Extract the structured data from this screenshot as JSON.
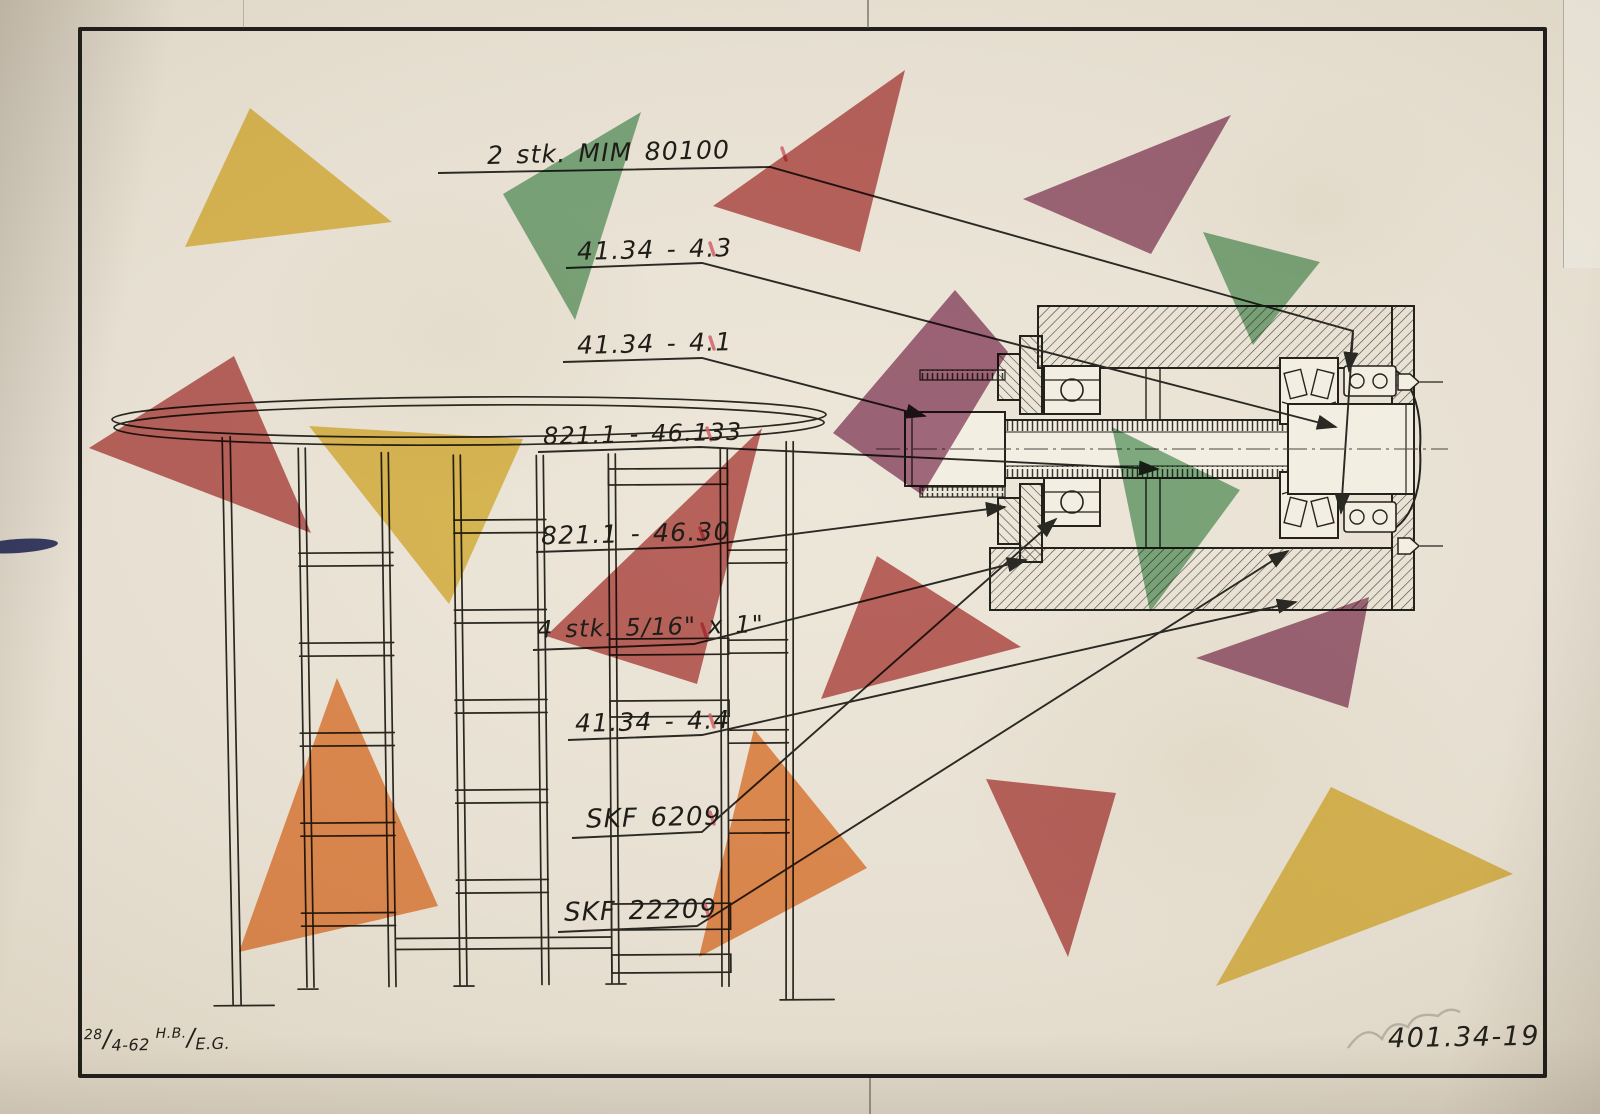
{
  "document_type": "vintage engineering drawing with colored paper triangles",
  "colors": {
    "paper_outer": "#b6ad9e",
    "paper_inner": "#e7e0d2",
    "border": "#211f1b",
    "ink": "#2b2923",
    "yellow": "#e7c350",
    "green": "#77ad82",
    "red": "#bf5c5b",
    "purple": "#9e5e7d",
    "orange": "#ee8d4b",
    "tick_red": "#d4606b",
    "ink_blot_blue": "#272c55",
    "pencil": "#8d867a"
  },
  "callouts": [
    {
      "id": "mim-80100",
      "text": "2 stk. MIM 80100",
      "x": 487,
      "y": 138,
      "size": 25,
      "leaders": [
        [
          [
            438,
            173
          ],
          [
            770,
            167
          ],
          [
            1353,
            331
          ],
          [
            1349,
            371
          ]
        ],
        [
          [
            1353,
            333
          ],
          [
            1341,
            513
          ]
        ]
      ],
      "tick": [
        782,
        148
      ]
    },
    {
      "id": "41-34-4-3",
      "text": "41.34 - 4.3",
      "x": 577,
      "y": 235,
      "size": 25,
      "leaders": [
        [
          [
            566,
            268
          ],
          [
            702,
            263
          ],
          [
            1336,
            427
          ]
        ]
      ],
      "tick": [
        710,
        243
      ]
    },
    {
      "id": "41-34-4-1",
      "text": "41.34 - 4.1",
      "x": 577,
      "y": 329,
      "size": 25,
      "leaders": [
        [
          [
            563,
            362
          ],
          [
            702,
            358
          ],
          [
            925,
            416
          ]
        ]
      ],
      "tick": [
        710,
        337
      ]
    },
    {
      "id": "821-1-46-133",
      "text": "821.1 - 46.133",
      "x": 543,
      "y": 420,
      "size": 24,
      "leaders": [
        [
          [
            538,
            452
          ],
          [
            700,
            447
          ],
          [
            1158,
            469
          ]
        ]
      ],
      "tick": [
        707,
        428
      ]
    },
    {
      "id": "821-1-46-30",
      "text": "821.1 - 46.30",
      "x": 541,
      "y": 519,
      "size": 25,
      "leaders": [
        [
          [
            536,
            552
          ],
          [
            692,
            547
          ],
          [
            1005,
            507
          ]
        ]
      ],
      "tick": [
        700,
        528
      ]
    },
    {
      "id": "4-stk-5-16-x-1",
      "text": "4 stk. 5/16\" x 1\"",
      "x": 537,
      "y": 613,
      "size": 24,
      "leaders": [
        [
          [
            533,
            650
          ],
          [
            694,
            644
          ],
          [
            1026,
            560
          ]
        ]
      ],
      "tick": [
        702,
        624
      ]
    },
    {
      "id": "41-34-4-4",
      "text": "41.34 - 4.4",
      "x": 575,
      "y": 707,
      "size": 25,
      "leaders": [
        [
          [
            568,
            740
          ],
          [
            702,
            735
          ],
          [
            1296,
            602
          ]
        ]
      ],
      "tick": [
        710,
        715
      ]
    },
    {
      "id": "skf-6209",
      "text": "SKF 6209",
      "x": 586,
      "y": 803,
      "size": 26,
      "leaders": [
        [
          [
            572,
            838
          ],
          [
            702,
            832
          ],
          [
            1056,
            519
          ]
        ]
      ],
      "tick": [
        710,
        812
      ]
    },
    {
      "id": "skf-22209",
      "text": "SKF 22209",
      "x": 564,
      "y": 896,
      "size": 26,
      "leaders": [
        [
          [
            558,
            932
          ],
          [
            697,
            926
          ],
          [
            1288,
            551
          ]
        ]
      ],
      "tick": [
        705,
        905
      ]
    }
  ],
  "shapes": [
    {
      "color": "yellow",
      "points": "250,108 392,222 185,247"
    },
    {
      "color": "green",
      "points": "641,112 503,194 575,320"
    },
    {
      "color": "red",
      "points": "905,70 713,206 860,252"
    },
    {
      "color": "purple",
      "points": "1231,115 1023,199 1151,254"
    },
    {
      "color": "green",
      "points": "1203,232 1320,262 1253,345"
    },
    {
      "color": "purple",
      "points": "955,290 1008,352 922,495 833,433"
    },
    {
      "color": "red",
      "points": "234,356 89,448 311,533"
    },
    {
      "color": "yellow",
      "points": "309,426 523,439 449,604"
    },
    {
      "color": "red",
      "points": "762,428 546,636 697,684"
    },
    {
      "color": "green",
      "points": "1112,427 1240,490 1150,612"
    },
    {
      "color": "red",
      "points": "877,556 821,699 1021,647"
    },
    {
      "color": "purple",
      "points": "1369,597 1196,658 1348,708"
    },
    {
      "color": "orange",
      "points": "337,678 239,952 438,906"
    },
    {
      "color": "orange",
      "points": "754,729 867,868 699,957"
    },
    {
      "color": "red",
      "points": "986,779 1116,793 1068,957"
    },
    {
      "color": "yellow",
      "points": "1331,787 1513,874 1216,986"
    }
  ],
  "title_block": {
    "day": "28",
    "date_rest": "4-62",
    "sig_top": "H.B.",
    "sig_bottom": "E.G.",
    "drawing_number": "401.34-19"
  }
}
